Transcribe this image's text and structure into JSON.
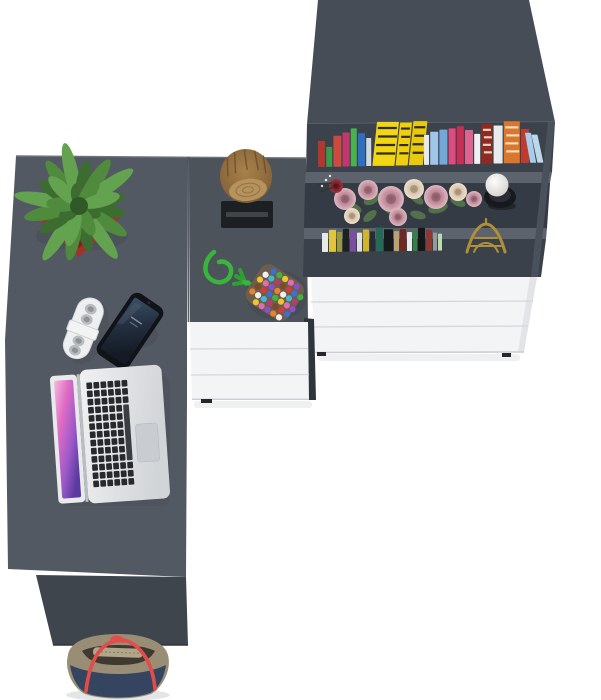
{
  "scene": {
    "description": "Top-down 3D render of a grey office desk with return and bookcase, white drawers, laptop, phone, power strip, potted succulent, tree-stump stool, pom-pom trivet, books, flowers, candle, Eiffel tower figurine and a handbag on the floor",
    "items": [
      "desk",
      "desk-return",
      "bookcase",
      "white-drawer-units",
      "tree-stump-decoration",
      "potted-succulent",
      "power-strip",
      "smartphone",
      "laptop",
      "pom-pom-trivet",
      "rose-bouquet",
      "candle-holder",
      "eiffel-tower-figurine",
      "books",
      "handbag"
    ],
    "colors": {
      "floor": "#ffffff",
      "desk_main": "#535962",
      "desk_return": "#4d535b",
      "desk_edge_highlight": "#6e747d",
      "seam": "#3d434b",
      "front_panel": "#3e454d",
      "bookcase_top": "#464d56",
      "bookcase_side": "#4a515b",
      "shelf_interior_1": "#3b424b",
      "shelf_interior_2": "#343b44",
      "shelf_interior_3": "#3a414a",
      "shelf_edge": "#5c636d",
      "drawer_front": "#f3f4f6",
      "drawer_seam": "#d4d7da",
      "drawer_side": "#e2e4e7",
      "drawer_foot": "#24282d",
      "drawer_dark_side": "#2f353c",
      "mat_black": "#1d2023",
      "mat_band": "#3f444a",
      "log_grain": "#b6925e",
      "pot_red": "#a1312b",
      "pot_rim": "#7e221d",
      "leaf_core": "#2f5a28",
      "strip_body": "#edeff0",
      "strip_socket": "#b9bcbf",
      "phone_body": "#101317",
      "laptop_bezel": "#e8eaeb",
      "laptop_hinge": "#b9bec2",
      "laptop_key": "#27292c",
      "laptop_trackpad": "#c9ccd0",
      "rope_green": "#39b53c",
      "rope_green_dark": "#2f9e33",
      "trivet_base": "#6e5d4a",
      "gold": "#b09036",
      "candle_cup": "#17191d",
      "bag_taupe": "#998d75",
      "bag_navy": "#35455f",
      "bag_strap": "#e34c4c",
      "bag_zip": "#b2a68a",
      "bag_opening": "#3f3a31",
      "shadow": "#e4e5e6"
    }
  },
  "books": {
    "top_row": {
      "x0": 318,
      "baseline": 167,
      "slope": 0.02,
      "gap": 1.2,
      "items": [
        [
          7,
          26,
          "#b2372f",
          0,
          ""
        ],
        [
          6,
          20,
          "#3c9a4b",
          0,
          ""
        ],
        [
          8,
          31,
          "#cc4a3f",
          0,
          ""
        ],
        [
          7,
          34,
          "#c2386e",
          0,
          ""
        ],
        [
          6,
          38,
          "#47b24f",
          0,
          ""
        ],
        [
          7,
          33,
          "#2f6fc2",
          0,
          ""
        ],
        [
          5,
          28,
          "#cfd8de",
          0,
          ""
        ],
        [
          22,
          44,
          "#f2d614",
          -6,
          "dark"
        ],
        [
          12,
          43,
          "#efcf10",
          -6,
          "dark"
        ],
        [
          14,
          44,
          "#e8c90e",
          -6,
          "dark"
        ],
        [
          5,
          30,
          "#e8ebee",
          0,
          ""
        ],
        [
          8,
          33,
          "#9fc6e8",
          0,
          ""
        ],
        [
          8,
          35,
          "#74a8d8",
          0,
          ""
        ],
        [
          7,
          36,
          "#e04a7e",
          0,
          ""
        ],
        [
          7,
          38,
          "#c92f55",
          0,
          ""
        ],
        [
          8,
          34,
          "#de6390",
          0,
          ""
        ],
        [
          6,
          30,
          "#eef0f2",
          0,
          ""
        ],
        [
          11,
          40,
          "#8f2a22",
          0,
          "light"
        ],
        [
          9,
          38,
          "#e9ebed",
          0,
          ""
        ],
        [
          16,
          42,
          "#d9782c",
          0,
          "light"
        ],
        [
          8,
          34,
          "#bf3b31",
          0,
          ""
        ],
        [
          6,
          30,
          "#a8cde8",
          10,
          ""
        ],
        [
          6,
          28,
          "#bcd8ea",
          12,
          ""
        ]
      ]
    },
    "bottom_row": {
      "x0": 322,
      "baseline": 252,
      "slope": 0.012,
      "gap": 1,
      "items": [
        [
          6,
          19,
          "#e6e8ea",
          0,
          ""
        ],
        [
          7,
          22,
          "#e0c53e",
          0,
          ""
        ],
        [
          5,
          20,
          "#99993f",
          0,
          ""
        ],
        [
          6,
          23,
          "#1e2124",
          0,
          ""
        ],
        [
          6,
          21,
          "#7b4f9e",
          0,
          ""
        ],
        [
          5,
          19,
          "#dfe2e4",
          0,
          ""
        ],
        [
          6,
          22,
          "#d2b32c",
          0,
          ""
        ],
        [
          5,
          20,
          "#2a2d31",
          0,
          ""
        ],
        [
          7,
          24,
          "#246b57",
          0,
          ""
        ],
        [
          9,
          22,
          "#17191c",
          0,
          ""
        ],
        [
          5,
          20,
          "#c2a06a",
          0,
          ""
        ],
        [
          6,
          22,
          "#6e2a22",
          0,
          ""
        ],
        [
          5,
          19,
          "#e8eaec",
          0,
          ""
        ],
        [
          4,
          21,
          "#2e8440",
          0,
          ""
        ],
        [
          7,
          23,
          "#141618",
          0,
          ""
        ],
        [
          6,
          21,
          "#8a3a33",
          0,
          ""
        ],
        [
          4,
          18,
          "#95989c",
          0,
          ""
        ],
        [
          4,
          17,
          "#b7dcae",
          0,
          ""
        ]
      ]
    }
  },
  "trivet": {
    "palette": [
      "#d63b3b",
      "#3b6fd6",
      "#43b13f",
      "#e8c72e",
      "#e26bb2",
      "#8a4fc9",
      "#e8822e",
      "#f0f0f0",
      "#3bbcd6",
      "#b13f6e",
      "#7a4a2a"
    ],
    "cols": 7,
    "rows": 6
  },
  "plant": {
    "cx": 79,
    "cy": 206,
    "leaf_colors": [
      "#3c6c2f",
      "#4f8a3d",
      "#63a24e"
    ],
    "outer_leaves": 16,
    "inner_leaves": 9
  },
  "keyboard": {
    "cols": 6,
    "rows": 13
  },
  "flowers": {
    "roses": [
      [
        345,
        199,
        11,
        "P"
      ],
      [
        368,
        190,
        10,
        "P"
      ],
      [
        391,
        199,
        13,
        "P"
      ],
      [
        414,
        189,
        10,
        "C"
      ],
      [
        436,
        197,
        12,
        "P"
      ],
      [
        458,
        192,
        9,
        "C"
      ],
      [
        474,
        199,
        8,
        "P"
      ],
      [
        352,
        216,
        8,
        "C"
      ],
      [
        398,
        217,
        9,
        "P"
      ],
      [
        336,
        186,
        7,
        "R"
      ]
    ],
    "leaves": [
      [
        352,
        208,
        10,
        5,
        20
      ],
      [
        372,
        199,
        9,
        5,
        -30
      ],
      [
        394,
        210,
        10,
        5,
        10
      ],
      [
        416,
        198,
        9,
        4,
        40
      ],
      [
        438,
        208,
        10,
        5,
        -15
      ],
      [
        458,
        202,
        8,
        4,
        25
      ],
      [
        370,
        216,
        8,
        4,
        -40
      ],
      [
        418,
        215,
        8,
        4,
        15
      ],
      [
        340,
        196,
        7,
        4,
        -60
      ]
    ]
  }
}
